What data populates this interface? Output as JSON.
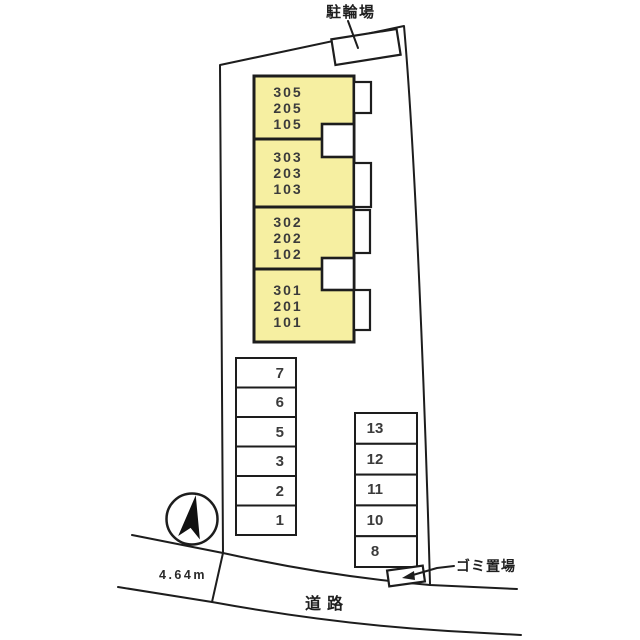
{
  "site_plan": {
    "labels": {
      "bicycle": "駐輪場",
      "garbage": "ゴミ置場",
      "road": "道路",
      "road_width": "4.64m"
    },
    "buildings": [
      {
        "rooms": [
          "305",
          "205",
          "105"
        ]
      },
      {
        "rooms": [
          "303",
          "203",
          "103"
        ]
      },
      {
        "rooms": [
          "302",
          "202",
          "102"
        ]
      },
      {
        "rooms": [
          "301",
          "201",
          "101"
        ]
      }
    ],
    "parking_left": [
      "7",
      "6",
      "5",
      "3",
      "2",
      "1"
    ],
    "parking_right": [
      "13",
      "12",
      "11",
      "10",
      "8"
    ],
    "icons": {
      "compass": "north-arrow-icon"
    },
    "colors": {
      "building_fill": "#F6EFA1",
      "line": "#1D1D1D",
      "background": "#FFFFFF",
      "text": "#3B3B3B"
    }
  }
}
